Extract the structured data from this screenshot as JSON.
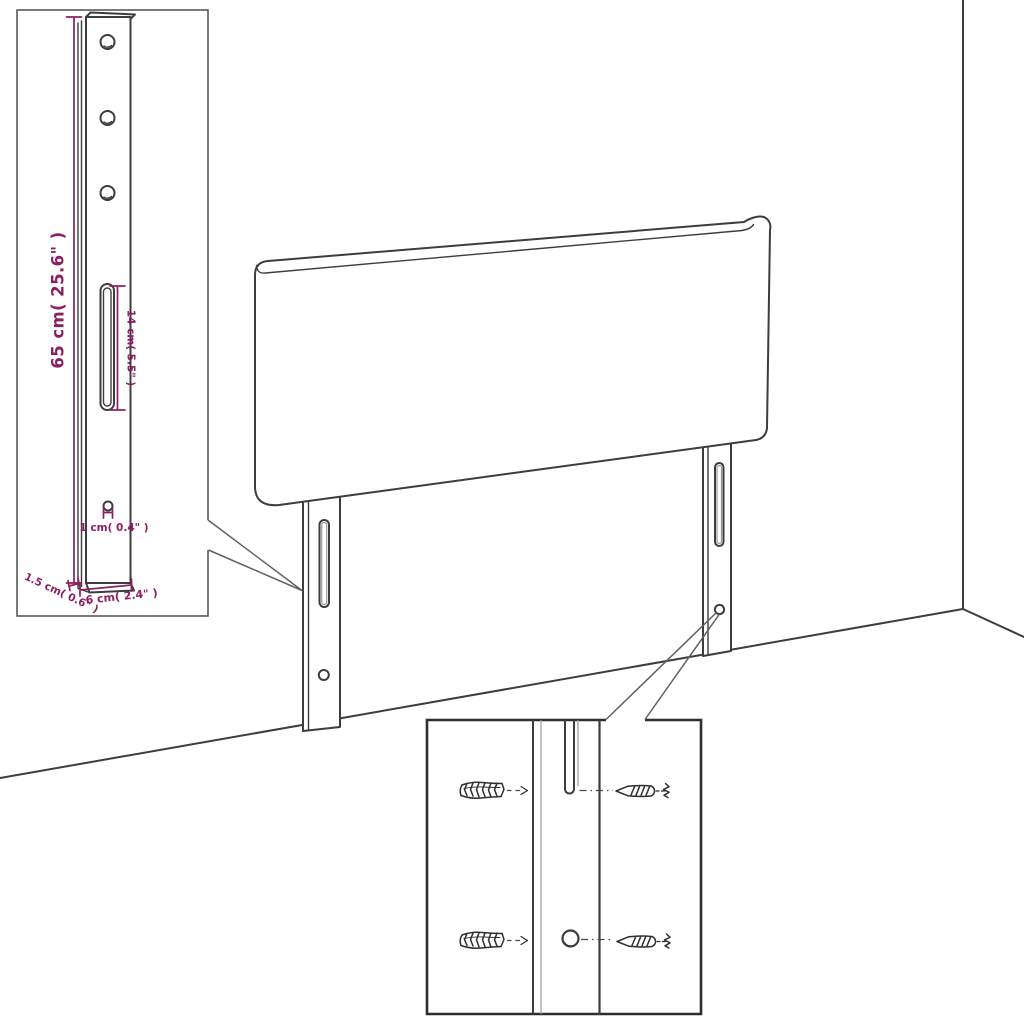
{
  "scene": {
    "description": "Line-art assembly diagram of a headboard with two mounting legs shown in a room corner, with a magnified bracket inset (top left) and a magnified wall-fixing hardware inset (bottom center)."
  },
  "labels": {
    "bracket_height": "65 cm( 25.6\" )",
    "slot_length": "14 cm( 5.5\" )",
    "hole_diameter": "1 cm( 0.4\" )",
    "bracket_thickness": "1.5 cm( 0.6\" )",
    "bracket_width": "6 cm( 2.4\" )"
  },
  "colors": {
    "background": "#ffffff",
    "line_art": "#3d3d3d",
    "dimension_accent": "#8C1F63",
    "leader_line": "#606060"
  }
}
